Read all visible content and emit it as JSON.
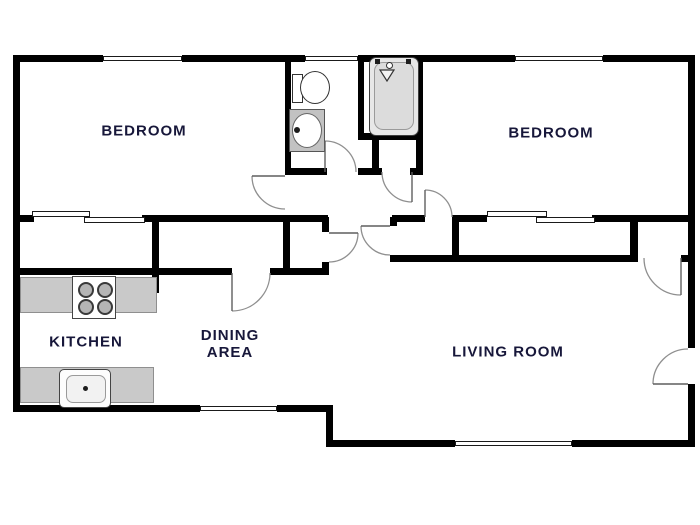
{
  "diagram": {
    "type": "apartment-floor-plan",
    "colors": {
      "wall": "#000000",
      "counter": "#c9c9c9",
      "label": "#17173a",
      "door_arc": "#8f8f8f",
      "background": "#ffffff"
    },
    "rooms": {
      "bedroom1": {
        "label": "BEDROOM"
      },
      "bedroom2": {
        "label": "BEDROOM"
      },
      "kitchen": {
        "label": "KITCHEN"
      },
      "dining": {
        "label_line1": "DINING",
        "label_line2": "AREA"
      },
      "living": {
        "label": "LIVING ROOM"
      }
    },
    "fixtures": [
      "toilet",
      "bathroom-sink",
      "bathtub",
      "stove",
      "kitchen-sink"
    ],
    "features": {
      "windows": 5,
      "swing_doors": 9,
      "sliding_closets": 2
    }
  }
}
